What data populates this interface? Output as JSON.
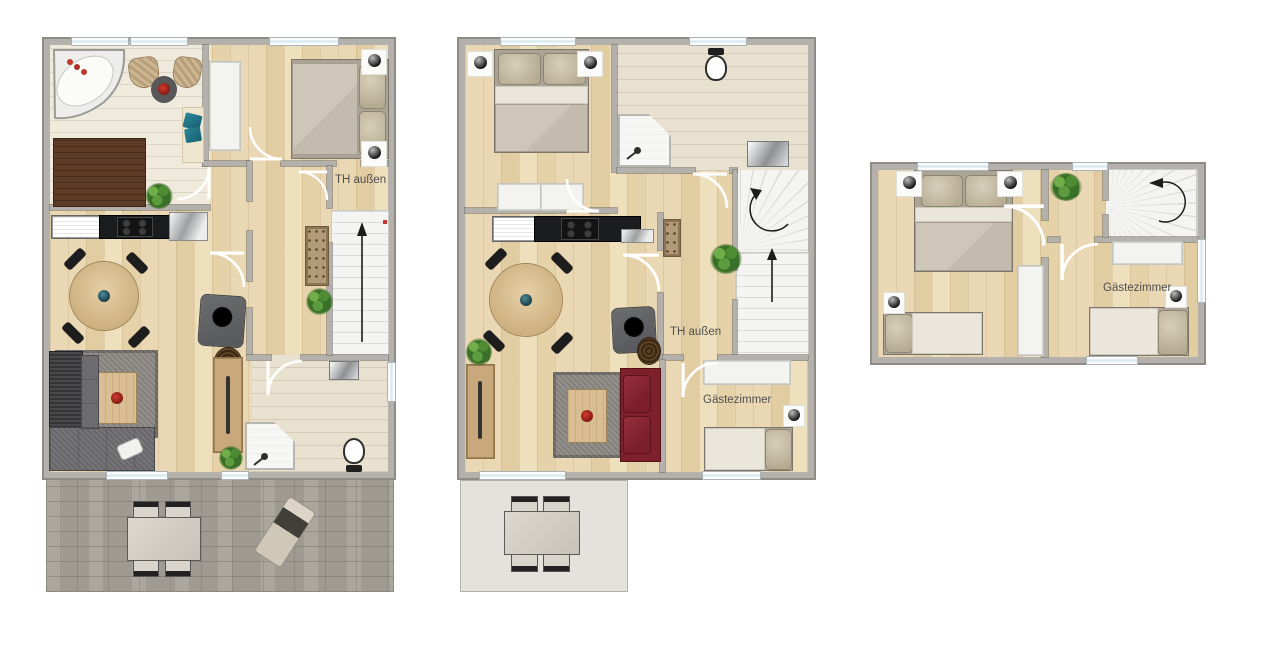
{
  "colors": {
    "wall": "#b4b1ad",
    "walledge": "#8f8c88",
    "wood": "#ead8b4",
    "tile": "#f0eadd",
    "bath": "#e9e1cf",
    "stairsbg": "#f4f4f2",
    "stairline": "#dadad6",
    "stone": "#a6a198",
    "terrace": "#e4e2dd",
    "redsofa": "#7e202a",
    "tan": "#c9a97c",
    "tablewood": "#d9be93",
    "rug": "#8e8a85",
    "green": "#3a7026",
    "label": "#4f4f4d",
    "brown": "#5e3b27"
  },
  "plans": [
    {
      "stair_label": "TH außen"
    },
    {
      "stair_label": "TH außen",
      "guest_room_label": "Gästezimmer"
    },
    {
      "guest_room_label": "Gästezimmer"
    }
  ]
}
